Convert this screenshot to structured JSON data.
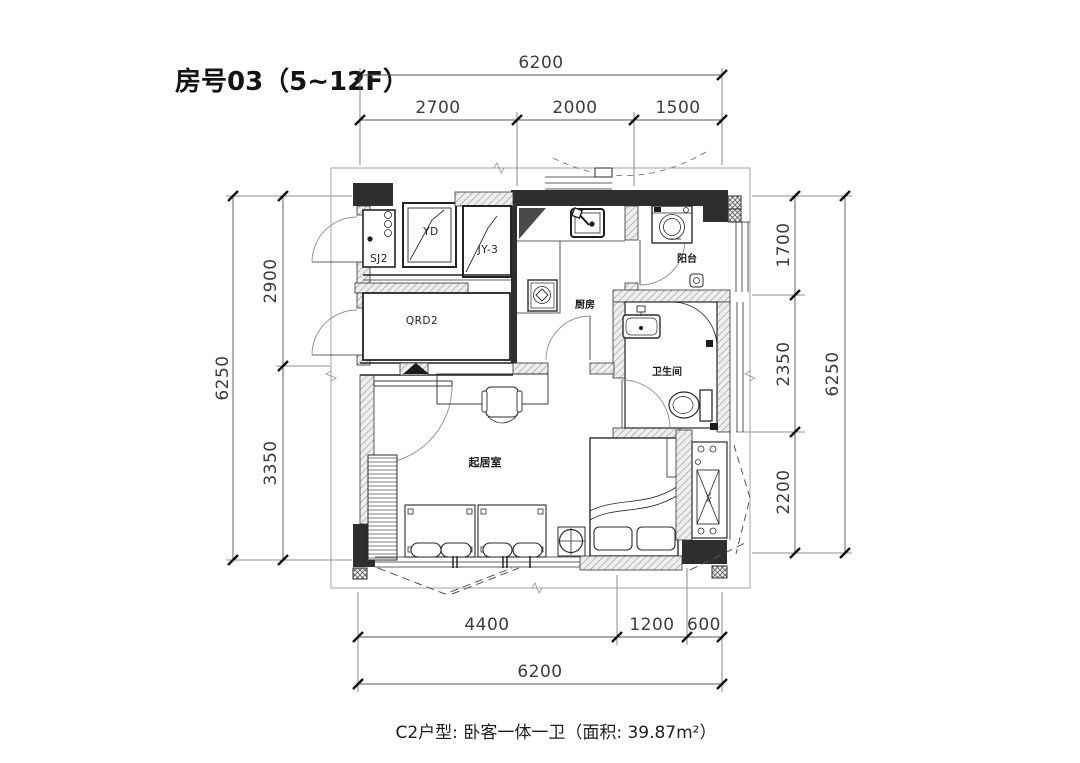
{
  "title": "房号03（5~12F）",
  "caption": "C2户型: 卧客一体一卫（面积: 39.87m²）",
  "dims": {
    "top_total": "6200",
    "top": [
      "2700",
      "2000",
      "1500"
    ],
    "left_total": "6250",
    "left": [
      "2900",
      "3350"
    ],
    "right": [
      "1700",
      "2350",
      "2200"
    ],
    "right_total": "6250",
    "bottom": [
      "4400",
      "1200",
      "600"
    ],
    "bottom_total": "6200"
  },
  "labels": {
    "storage": "SJ2",
    "duct_yd": "YD",
    "duct_jy3": "JY-3",
    "qrd2": "QRD2",
    "kitchen": "厨房",
    "balcony": "阳台",
    "bathroom": "卫生间",
    "living_room": "起居室",
    "ac_unit": "A/C"
  },
  "colors": {
    "wall_fill": "#2e2e2e",
    "line": "#2b2b2b",
    "background": "#ffffff"
  }
}
